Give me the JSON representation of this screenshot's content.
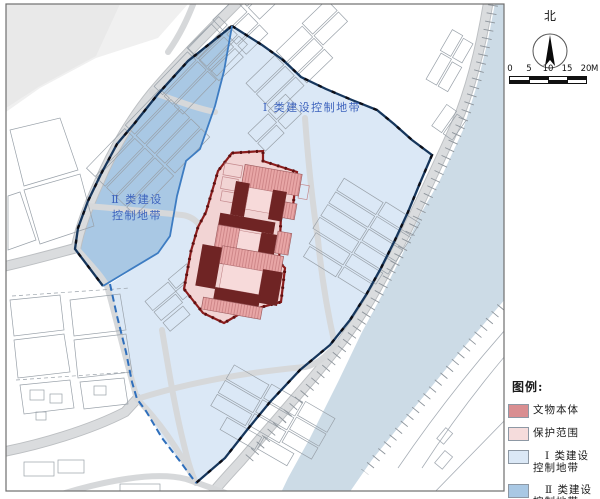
{
  "map": {
    "zone1_label": "Ⅰ 类建设控制地带",
    "zone2_label_line1": "Ⅱ 类建设",
    "zone2_label_line2": "控制地带"
  },
  "compass": {
    "north_label": "北"
  },
  "scale_bar": {
    "tick_labels": [
      "0",
      "5",
      "10",
      "15",
      "20"
    ],
    "unit": "M"
  },
  "legend": {
    "title": "图例:",
    "items": [
      {
        "label": "文物本体",
        "color": "#d98e91"
      },
      {
        "label": "保护范围",
        "color": "#f5dcdc"
      },
      {
        "label": "Ⅰ 类建设控制地带",
        "color": "#dbe8f6"
      },
      {
        "label": "Ⅱ 类建设控制地带",
        "color": "#a9c8e4"
      }
    ]
  },
  "colors": {
    "monument_dark_red": "#6f2424",
    "protection_pink": "#f2d4d4",
    "protection_border": "#8a1c1c",
    "zone1_fill": "#dbe8f6",
    "zone2_fill": "#a9c8e4",
    "zone_outer_boundary": "#16365c",
    "zone_inner_boundary": "#3d7cc2",
    "river": "#ccdbe6",
    "road": "#dadcde",
    "label_blue": "#3d63bd"
  }
}
